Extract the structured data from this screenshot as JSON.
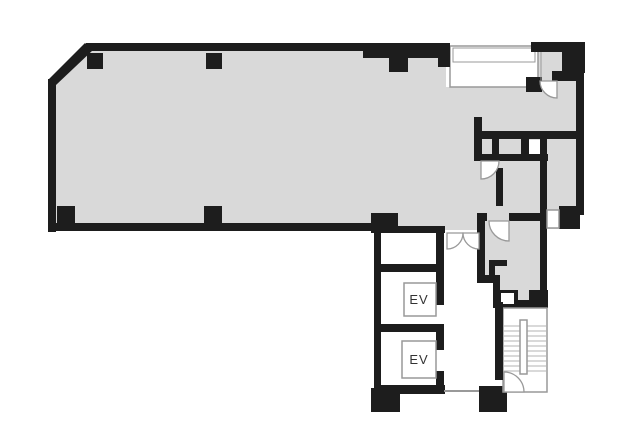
{
  "floor_plan": {
    "labels": {
      "elevator_1": "EV",
      "elevator_2": "EV"
    },
    "colors": {
      "floor": "#d9d9d9",
      "wall": "#1d1d1d",
      "background": "#ffffff",
      "thin_line": "#999999",
      "tread_line": "#b3b3b3",
      "label_text": "#333333"
    }
  }
}
